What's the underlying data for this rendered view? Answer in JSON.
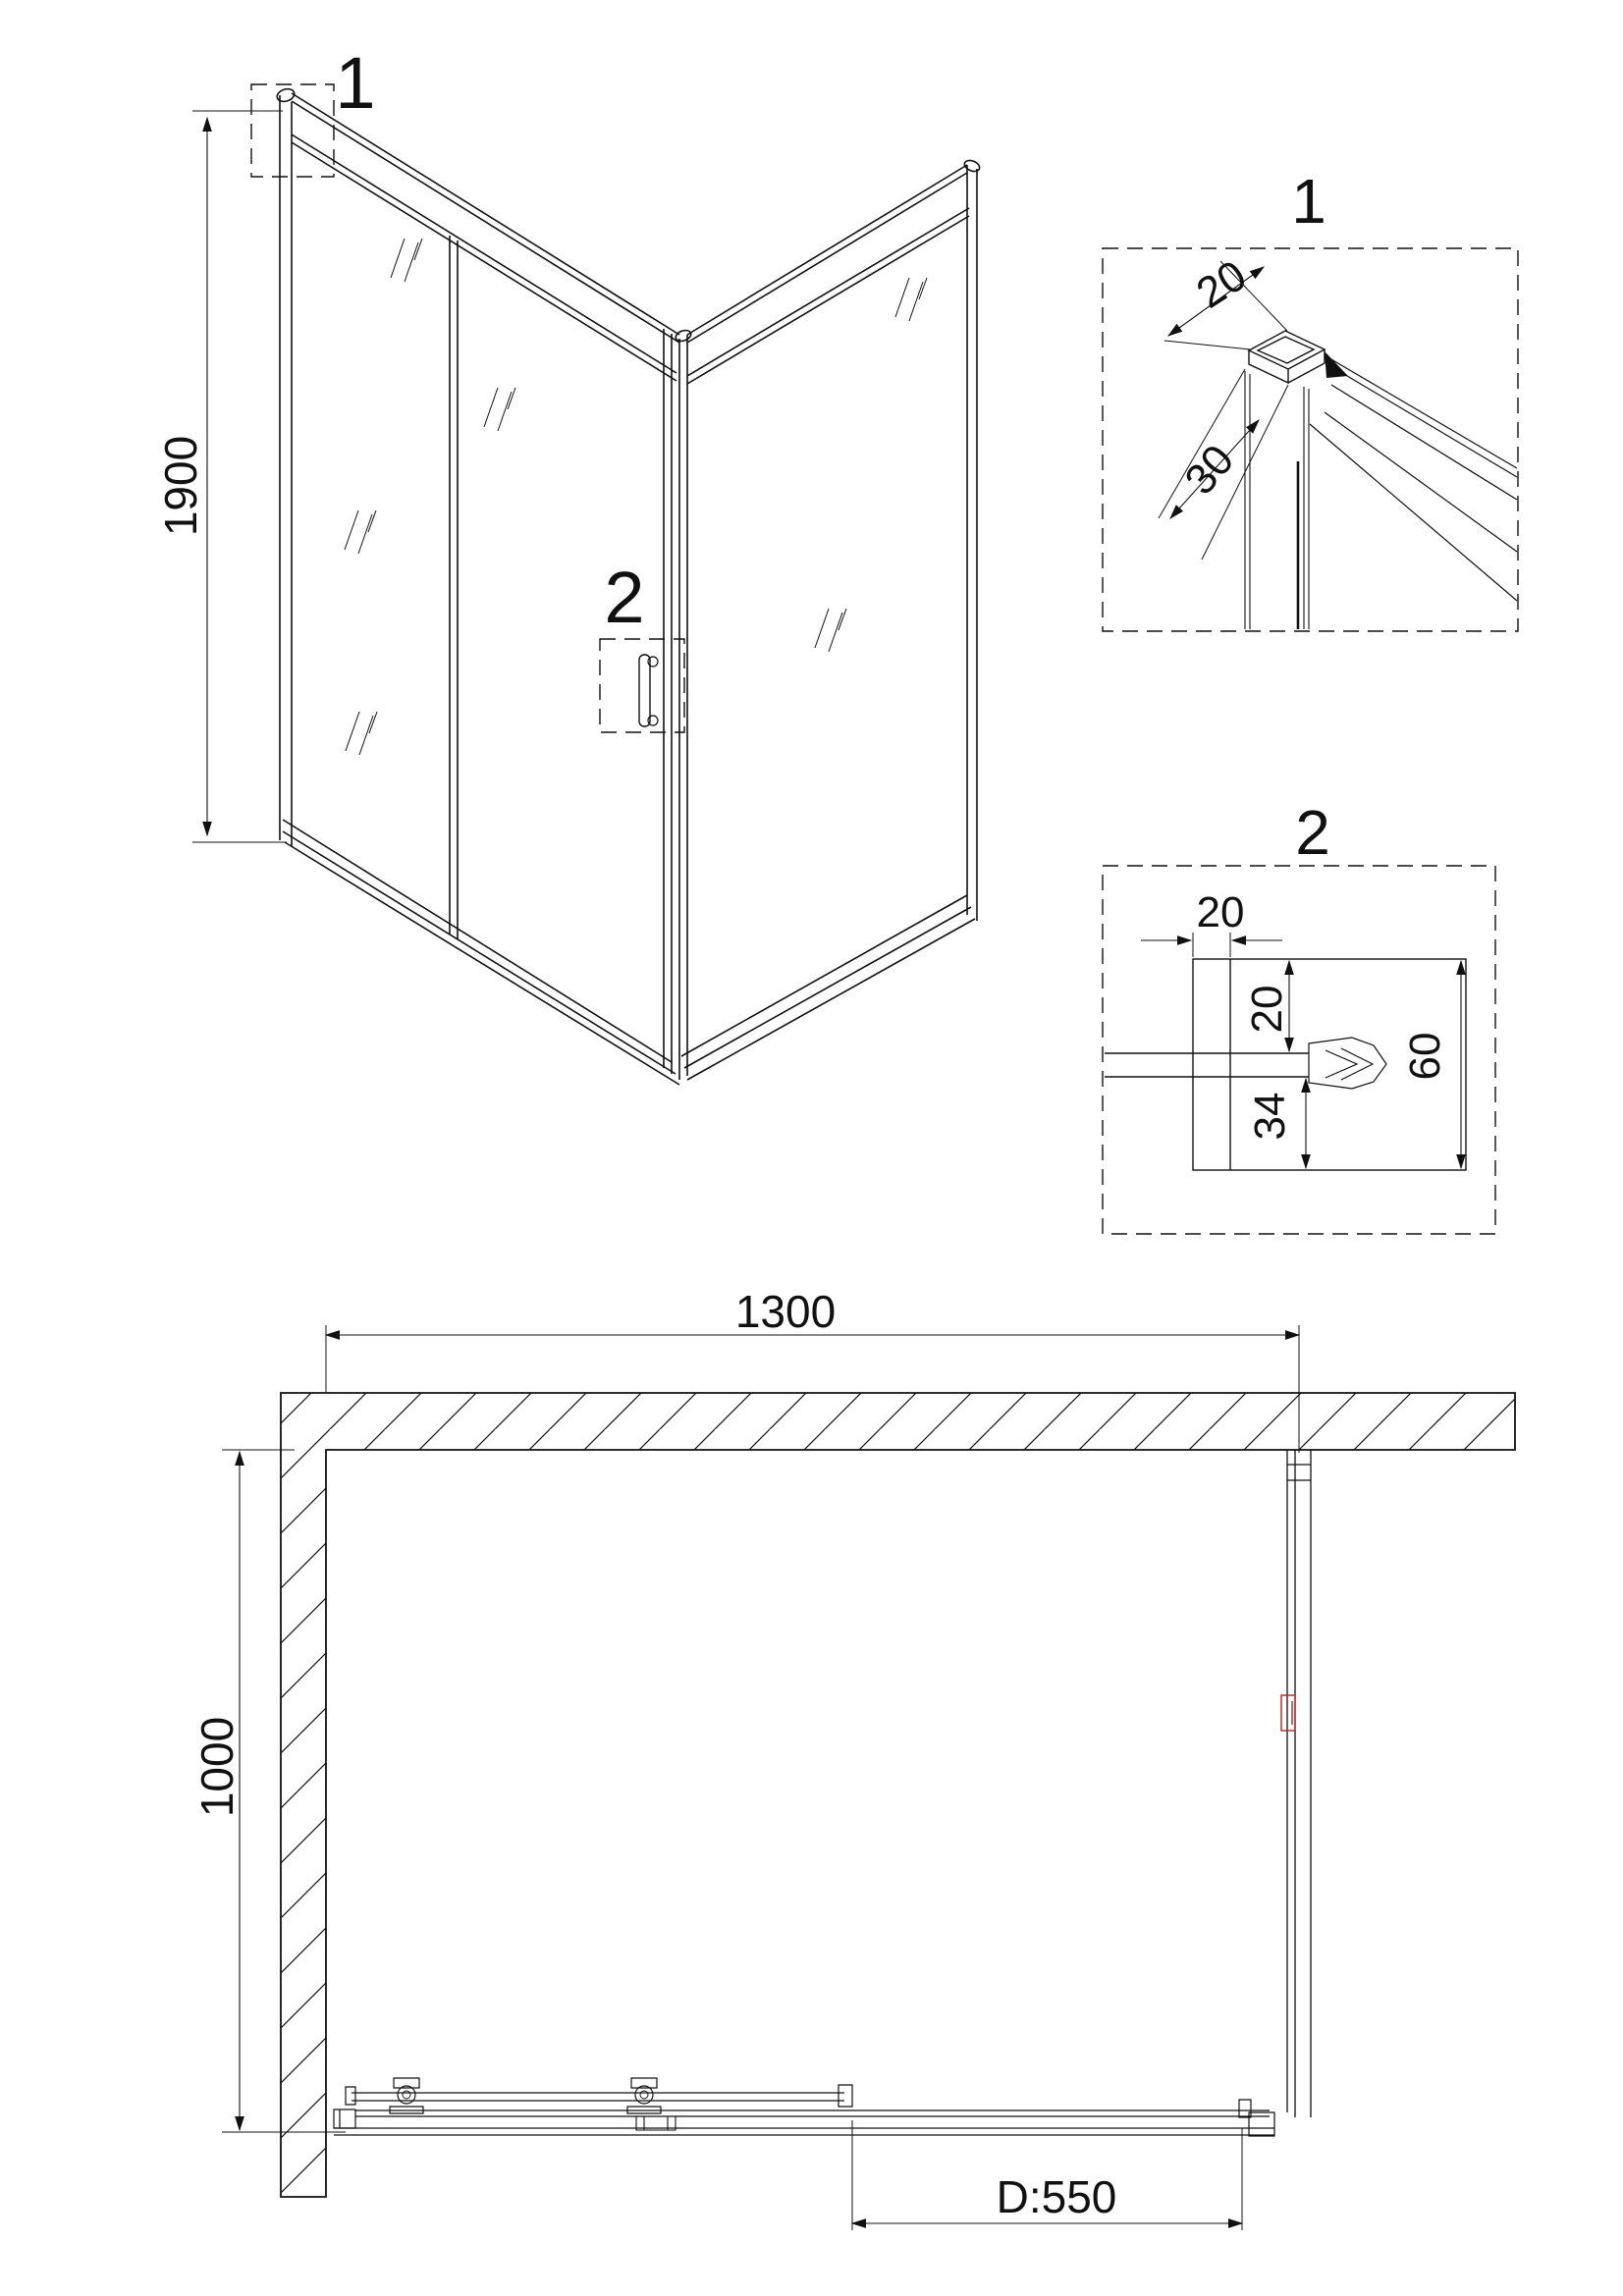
{
  "title": "Shower enclosure technical drawing",
  "colors": {
    "line": "#111111",
    "red": "#b32424",
    "background": "#ffffff"
  },
  "iso_view": {
    "height_dim": "1900",
    "callout_frame": "1",
    "callout_handle": "2"
  },
  "detail_1": {
    "label": "1",
    "profile_width_dim": "20",
    "profile_depth_dim": "30"
  },
  "detail_2": {
    "label": "2",
    "wall_profile_width_dim": "20",
    "top_clearance_dim": "20",
    "bottom_clearance_dim": "34",
    "total_depth_dim": "60"
  },
  "plan_view": {
    "width_dim": "1300",
    "depth_dim": "1000",
    "door_width_dim": "D:550"
  }
}
